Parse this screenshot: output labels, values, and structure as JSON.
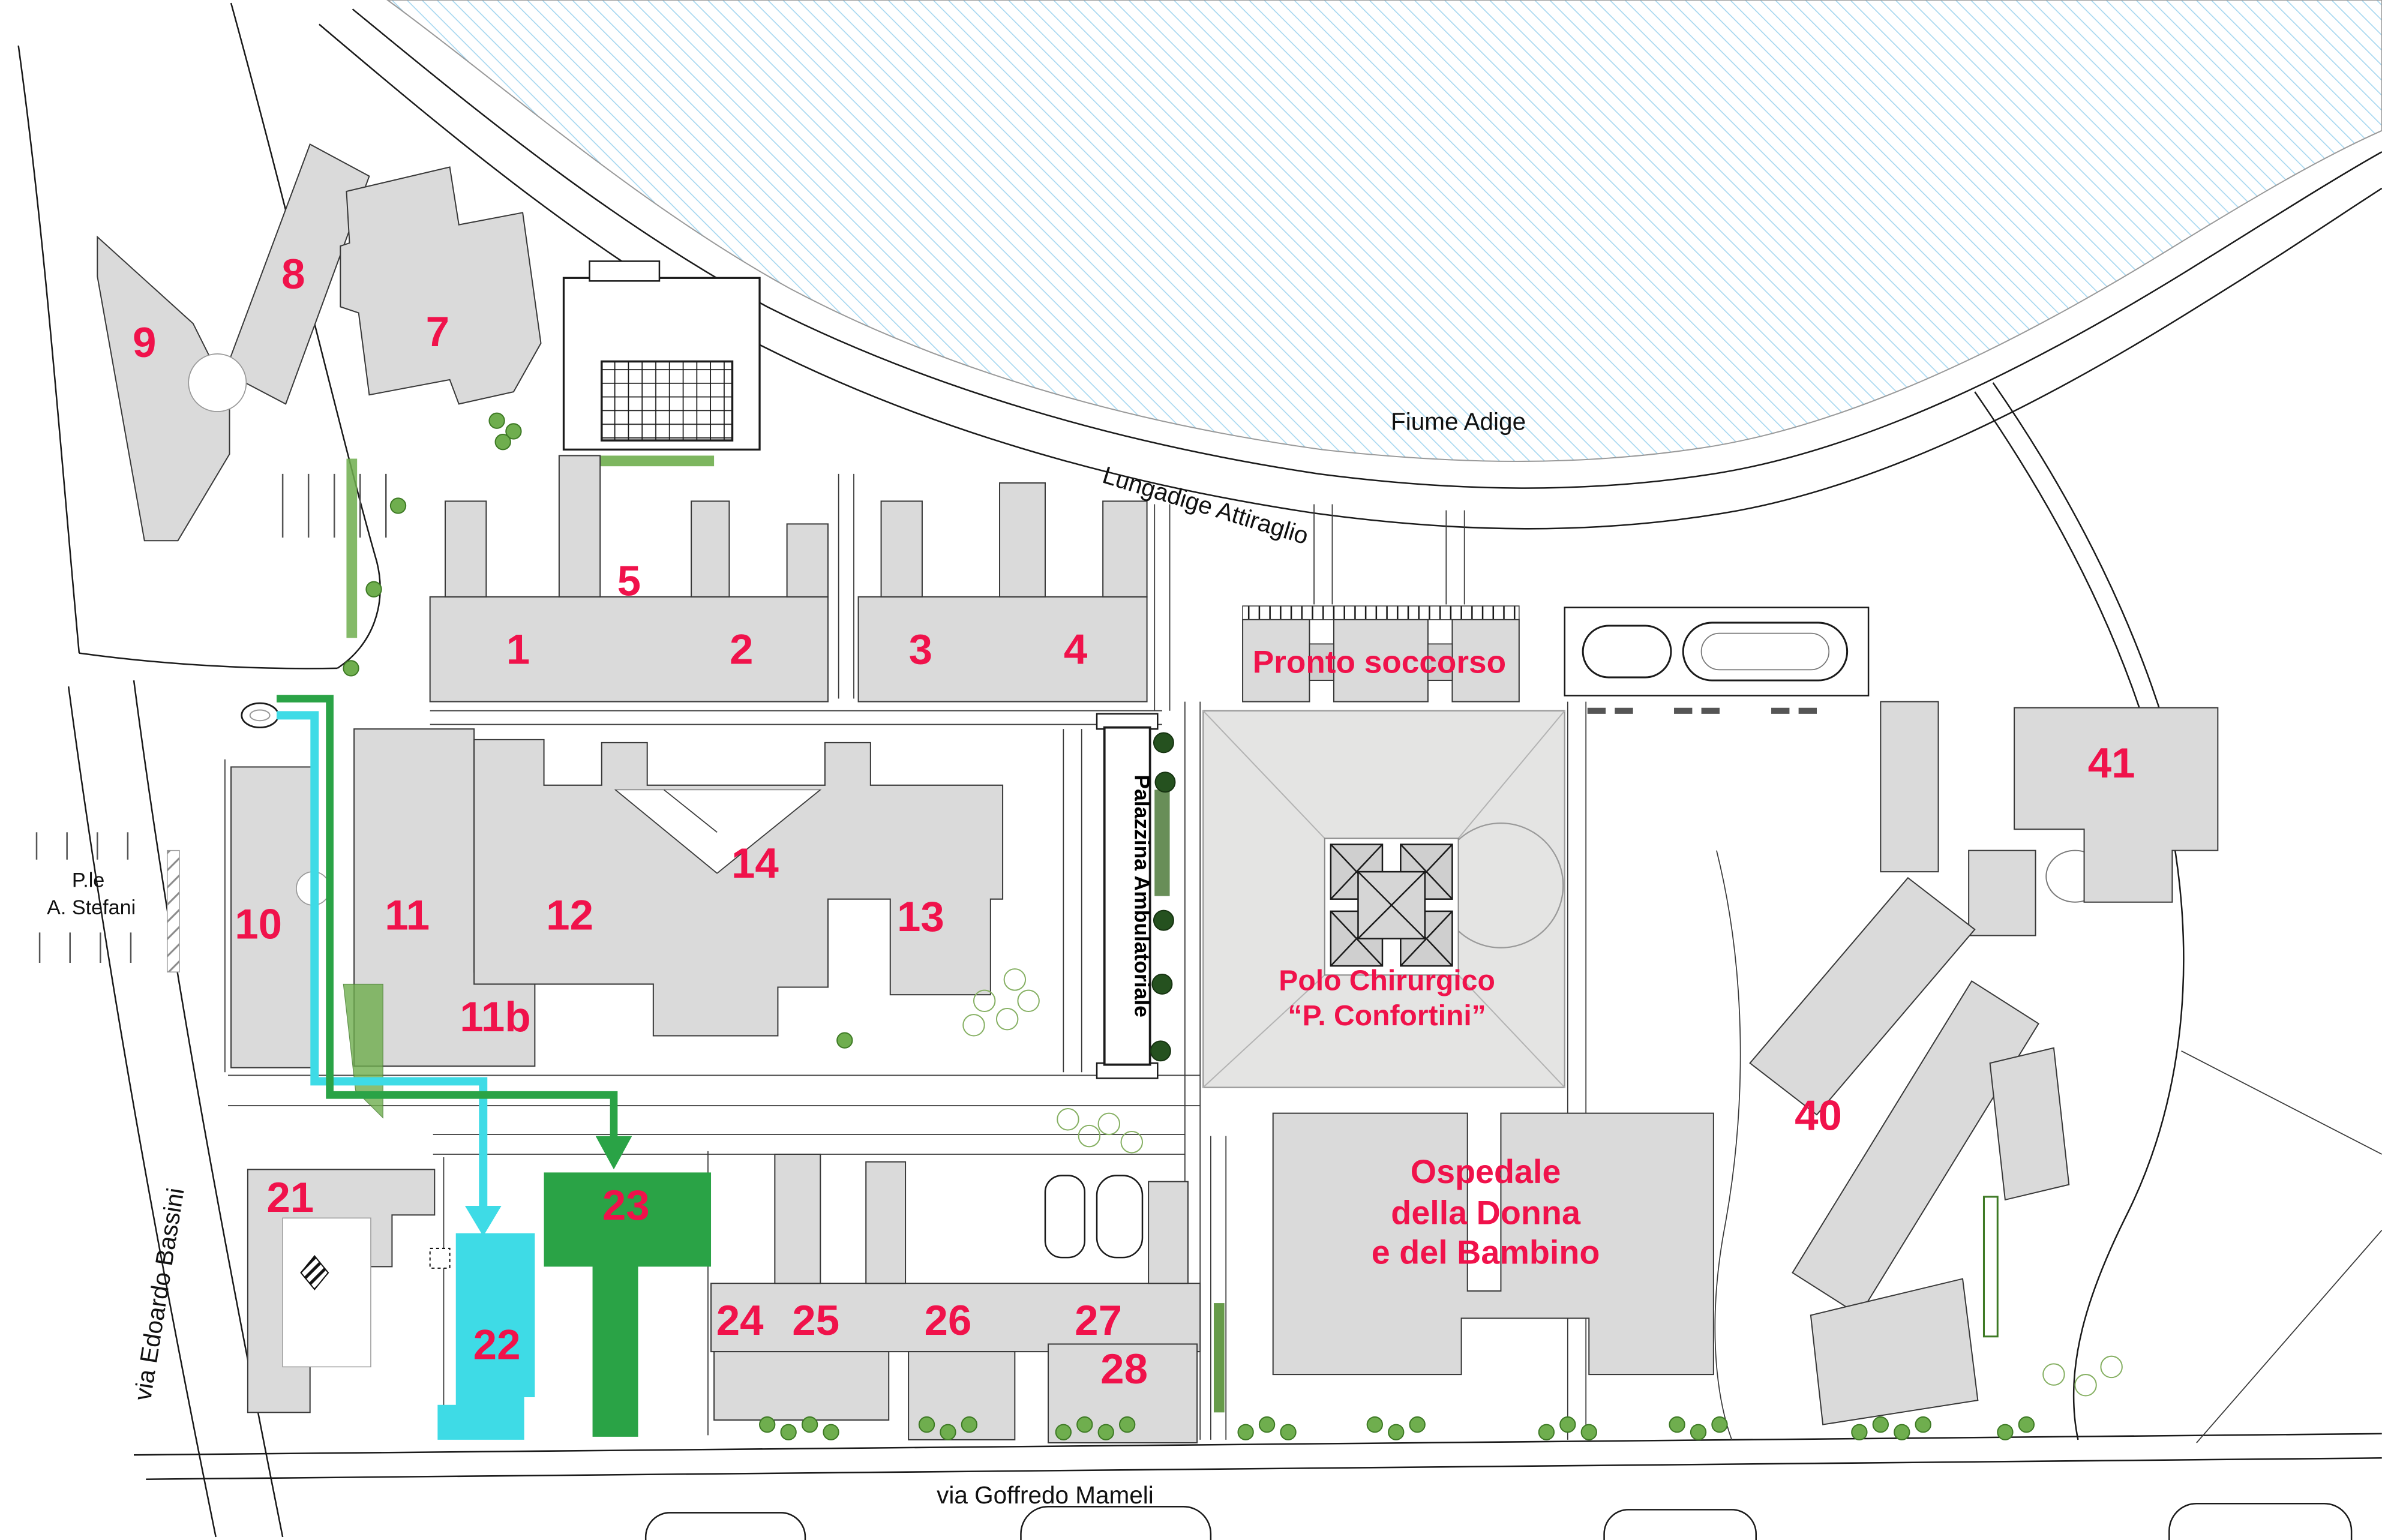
{
  "building_numbers": {
    "b1": "1",
    "b2": "2",
    "b3": "3",
    "b4": "4",
    "b5": "5",
    "b7": "7",
    "b8": "8",
    "b9": "9",
    "b10": "10",
    "b11": "11",
    "b11b": "11b",
    "b12": "12",
    "b13": "13",
    "b14": "14",
    "b21": "21",
    "b22": "22",
    "b23": "23",
    "b24": "24",
    "b25": "25",
    "b26": "26",
    "b27": "27",
    "b28": "28",
    "b40": "40",
    "b41": "41"
  },
  "labels": {
    "river": "Fiume Adige",
    "lungadige": "Lungadige Attiraglio",
    "mameli": "via Goffredo Mameli",
    "bassini": "via Edoardo Bassini",
    "piazzale_l1": "P.le",
    "piazzale_l2": "A. Stefani",
    "pronto": "Pronto soccorso",
    "polo_l1": "Polo Chirurgico",
    "polo_l2": "“P. Confortini”",
    "ospedale_l1": "Ospedale",
    "ospedale_l2": "della Donna",
    "ospedale_l3": "e del Bambino",
    "palazzina": "Palazzina Ambulatoriale"
  },
  "colors": {
    "label_red": "#F0124B",
    "building_gray": "#DADADA",
    "river_hatch": "#A6D7F0",
    "route_cyan": "#3EDBE6",
    "route_green": "#2AA346",
    "tree_green": "#6FAE4E",
    "tree_dark": "#25511F"
  }
}
